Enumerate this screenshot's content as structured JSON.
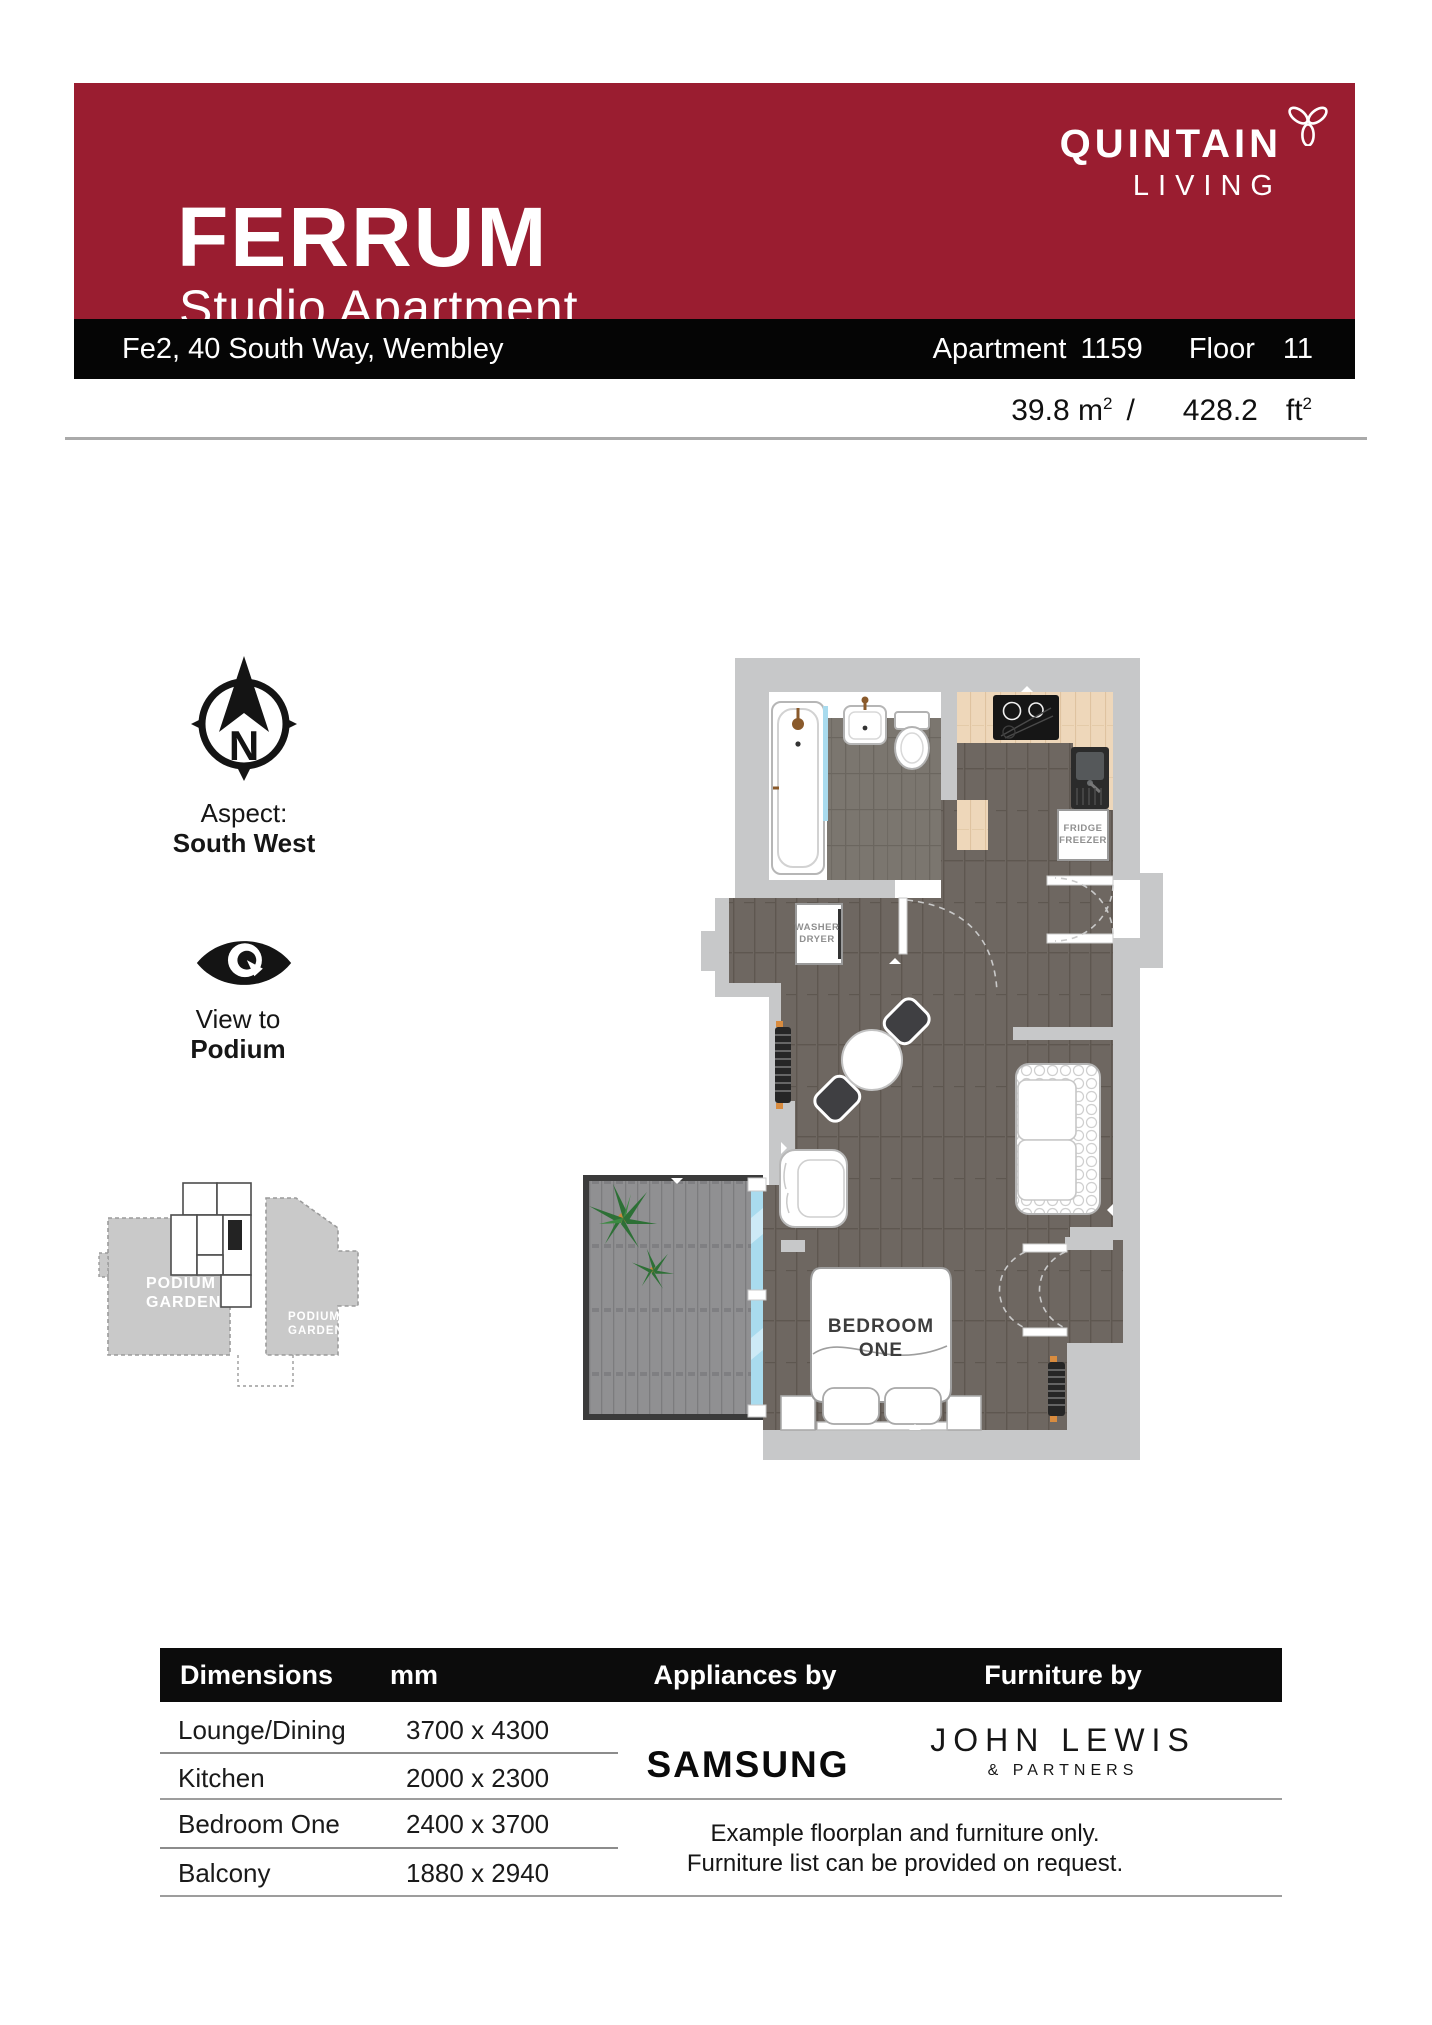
{
  "header": {
    "title": "FERRUM",
    "subtitle": "Studio Apartment",
    "brand_line1": "QUINTAIN",
    "brand_line2": "LIVING"
  },
  "address_bar": {
    "address": "Fe2, 40 South Way, Wembley",
    "apartment_label": "Apartment",
    "apartment_number": "1159",
    "floor_label": "Floor",
    "floor_number": "11"
  },
  "area": {
    "metric": "39.8 m",
    "metric_sup": "2",
    "separator": "/",
    "imperial_value": "428.2",
    "imperial_unit": "ft",
    "imperial_sup": "2"
  },
  "compass": {
    "letter": "N",
    "aspect_label": "Aspect:",
    "aspect_value": "South West"
  },
  "view": {
    "label": "View to",
    "value": "Podium"
  },
  "minimap": {
    "garden_left_line1": "PODIUM",
    "garden_left_line2": "GARDEN",
    "garden_right_line1": "PODIUM",
    "garden_right_line2": "GARDEN"
  },
  "floorplan": {
    "bedroom_line1": "BEDROOM",
    "bedroom_line2": "ONE",
    "fridge_line1": "FRIDGE",
    "fridge_line2": "FREEZER",
    "washer_line1": "WASHER",
    "washer_line2": "DRYER"
  },
  "table": {
    "headers": [
      "Dimensions",
      "mm",
      "Appliances by",
      "Furniture by"
    ],
    "rows": [
      {
        "room": "Lounge/Dining",
        "size": "3700 x 4300"
      },
      {
        "room": "Kitchen",
        "size": "2000 x 2300"
      },
      {
        "room": "Bedroom One",
        "size": "2400 x 3700"
      },
      {
        "room": "Balcony",
        "size": "1880 x 2940"
      }
    ]
  },
  "brands": {
    "appliances": "SAMSUNG",
    "furniture_line1": "JOHN LEWIS",
    "furniture_line2": "& PARTNERS"
  },
  "note": {
    "line1": "Example floorplan and furniture only.",
    "line2": "Furniture list can be provided on request."
  },
  "colors": {
    "brand_red": "#9a1d30",
    "bar_black": "#050505",
    "wall_gray": "#c7c8c9",
    "floor_wood": "#6e6761",
    "balcony_glass": "#a9dbee",
    "counter_beige": "#eed7ba"
  }
}
